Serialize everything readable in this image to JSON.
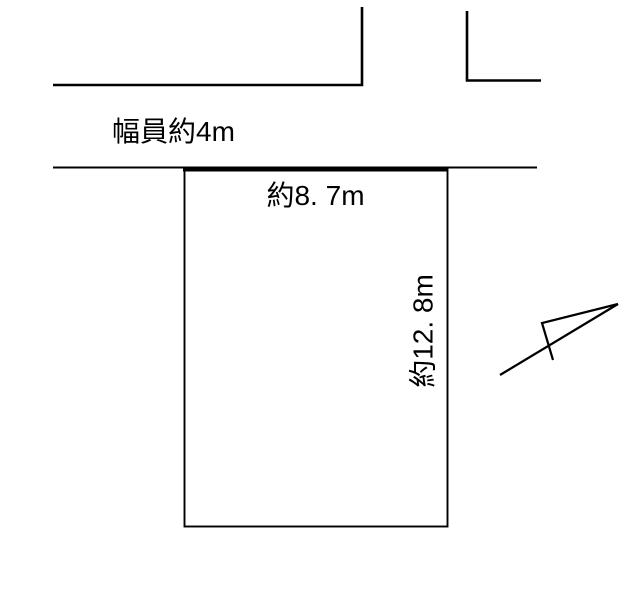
{
  "diagram": {
    "type": "land-plot-site-plan",
    "labels": {
      "road_width": "幅員約4m",
      "frontage": "約8. 7m",
      "depth": "約12. 8m"
    },
    "icons": {
      "north_arrow": "north-direction-arrow"
    },
    "colors": {
      "line": "#000000",
      "background": "#ffffff"
    }
  }
}
